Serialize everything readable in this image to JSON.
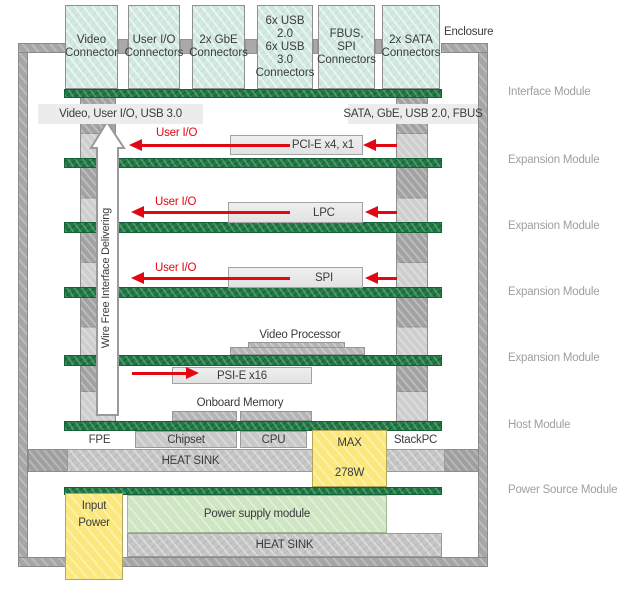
{
  "enclosure": {
    "label": "Enclosure"
  },
  "connectors": [
    {
      "l1": "Video",
      "l2": "Connector",
      "l3": ""
    },
    {
      "l1": "User I/O",
      "l2": "Connectors",
      "l3": ""
    },
    {
      "l1": "2x GbE",
      "l2": "Connectors",
      "l3": ""
    },
    {
      "l1": "6x USB 2.0",
      "l2": "6x USB 3.0",
      "l3": "Connectors"
    },
    {
      "l1": "FBUS, SPI",
      "l2": "Connectors",
      "l3": ""
    },
    {
      "l1": "2x SATA",
      "l2": "Connectors",
      "l3": ""
    }
  ],
  "bus_labels": {
    "left": "Video, User I/O, USB 3.0",
    "right": "SATA, GbE, USB 2.0, FBUS"
  },
  "wire_free_label": "Wire Free Interface Delivering",
  "expansion_rows": [
    {
      "user_io": "User I/O",
      "bus": "PCI-E x4, x1"
    },
    {
      "user_io": "User I/O",
      "bus": "LPC"
    },
    {
      "user_io": "User I/O",
      "bus": "SPI"
    }
  ],
  "host": {
    "video_processor": "Video Processor",
    "psi": "PSI-E x16",
    "onboard_memory": "Onboard Memory",
    "fpe": "FPE",
    "chipset": "Chipset",
    "cpu": "CPU",
    "max_l1": "MAX",
    "max_l2": "278W",
    "stackpc": "StackPC",
    "heatsink": "HEAT SINK"
  },
  "power": {
    "input_l1": "Input",
    "input_l2": "Power",
    "module": "Power supply module",
    "heatsink": "HEAT SINK"
  },
  "module_labels": [
    "Interface Module",
    "Expansion Module",
    "Expansion Module",
    "Expansion Module",
    "Expansion Module",
    "Host Module",
    "Power Source Module"
  ],
  "colors": {
    "accent_red": "#e30613",
    "pcb_green": "#1f7a44",
    "connector_teal": "#d2e9e2",
    "power_yellow": "#fbe87d",
    "supply_green": "#cfe6c3"
  }
}
